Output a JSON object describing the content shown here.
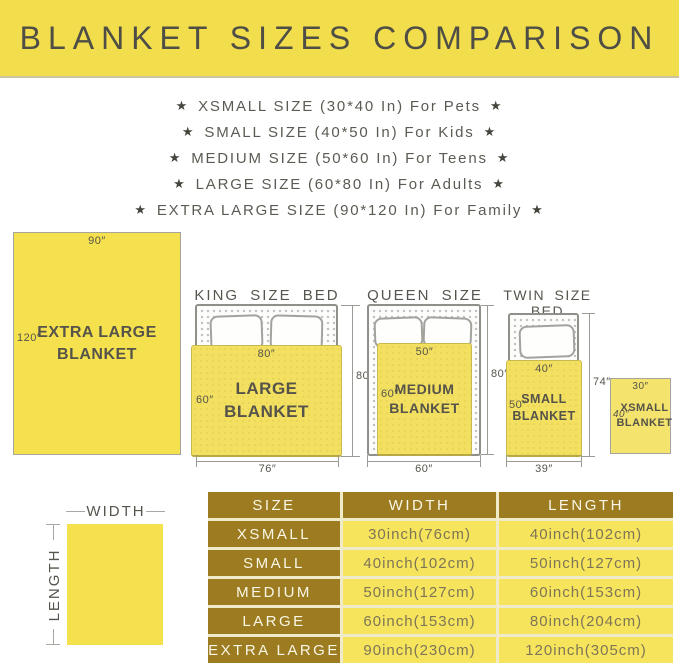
{
  "banner": {
    "title": "BLANKET SIZES COMPARISON"
  },
  "size_list": {
    "star": "★",
    "items": [
      {
        "text": "XSMALL SIZE (30*40 In) For Pets"
      },
      {
        "text": "SMALL SIZE (40*50 In) For Kids"
      },
      {
        "text": "MEDIUM SIZE (50*60 In) For Teens"
      },
      {
        "text": "LARGE SIZE (60*80 In) For Adults"
      },
      {
        "text": "EXTRA LARGE SIZE (90*120 In) For Family"
      }
    ]
  },
  "diagrams": {
    "xl_blanket": {
      "width_label": "90″",
      "length_label": "120″",
      "name": "EXTRA LARGE\nBLANKET"
    },
    "king": {
      "title": "KING SIZE BED",
      "blanket_name": "LARGE BLANKET",
      "blanket_width": "80″",
      "blanket_length": "60″",
      "bed_length": "80″",
      "bed_width": "76″"
    },
    "queen": {
      "title": "QUEEN SIZE BED",
      "blanket_name": "MEDIUM\nBLANKET",
      "blanket_width": "50″",
      "blanket_length": "60″",
      "bed_length": "80″",
      "bed_width": "60″"
    },
    "twin": {
      "title": "TWIN SIZE BED",
      "blanket_name": "SMALL\nBLANKET",
      "blanket_width": "40″",
      "blanket_length": "50″",
      "bed_length": "74″",
      "bed_width": "39″"
    },
    "xsmall_blanket": {
      "width_label": "30″",
      "length_label": "40″",
      "name": "XSMALL\nBLANKET"
    }
  },
  "legend": {
    "width": "WIDTH",
    "length": "LENGTH"
  },
  "table": {
    "headers": [
      "SIZE",
      "WIDTH",
      "LENGTH"
    ],
    "rows": [
      {
        "size": "XSMALL",
        "width": "30inch(76cm)",
        "length": "40inch(102cm)"
      },
      {
        "size": "SMALL",
        "width": "40inch(102cm)",
        "length": "50inch(127cm)"
      },
      {
        "size": "MEDIUM",
        "width": "50inch(127cm)",
        "length": "60inch(153cm)"
      },
      {
        "size": "LARGE",
        "width": "60inch(153cm)",
        "length": "80inch(204cm)"
      },
      {
        "size": "EXTRA LARGE",
        "width": "90inch(230cm)",
        "length": "120inch(305cm)"
      }
    ]
  },
  "colors": {
    "banner_bg": "#F2DE4D",
    "blanket_yellow": "#F5E14E",
    "bed_blanket_yellow": "#F3E061",
    "table_header_bg": "#9C7B21",
    "table_cell_bg": "#F6E45C",
    "table_header_text": "#FAF7E6",
    "table_cell_text": "#7E7557",
    "title_text": "#4E4E46",
    "body_text": "#5B5B53"
  }
}
